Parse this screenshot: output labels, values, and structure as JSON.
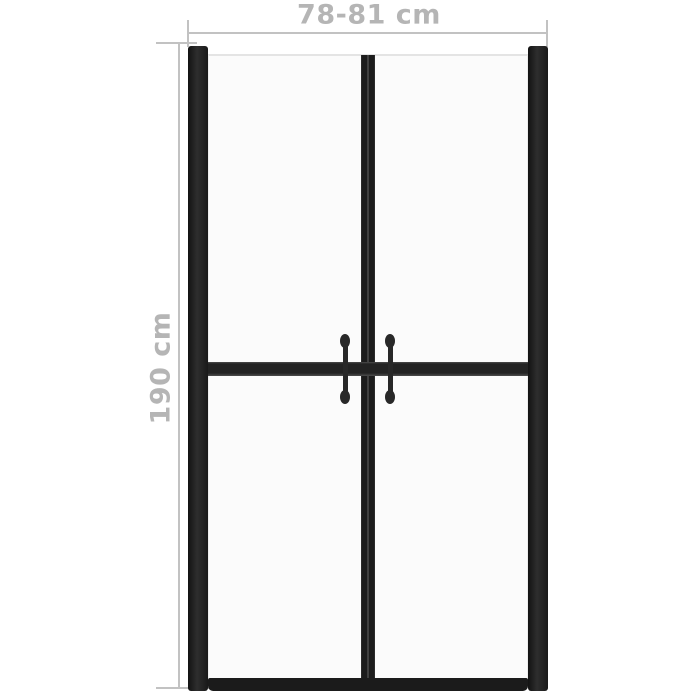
{
  "diagram": {
    "type": "product-dimension-drawing",
    "subject": "shower door with two framed panels and twin vertical handles",
    "dimension_labels": {
      "width": "78-81 cm",
      "height": "190 cm"
    },
    "colors": {
      "background": "#ffffff",
      "frame_dark": "#1e1e1e",
      "dimension_line_gray": "#c2c2c2",
      "label_text_gray": "#b5b5b5",
      "glass_fill": "#fbfbfb"
    },
    "parts": [
      "left-wall-profile",
      "right-wall-profile",
      "left-glass-panel",
      "right-glass-panel",
      "center-divider",
      "middle-crossbar",
      "bottom-rail",
      "left-handle",
      "right-handle"
    ]
  }
}
